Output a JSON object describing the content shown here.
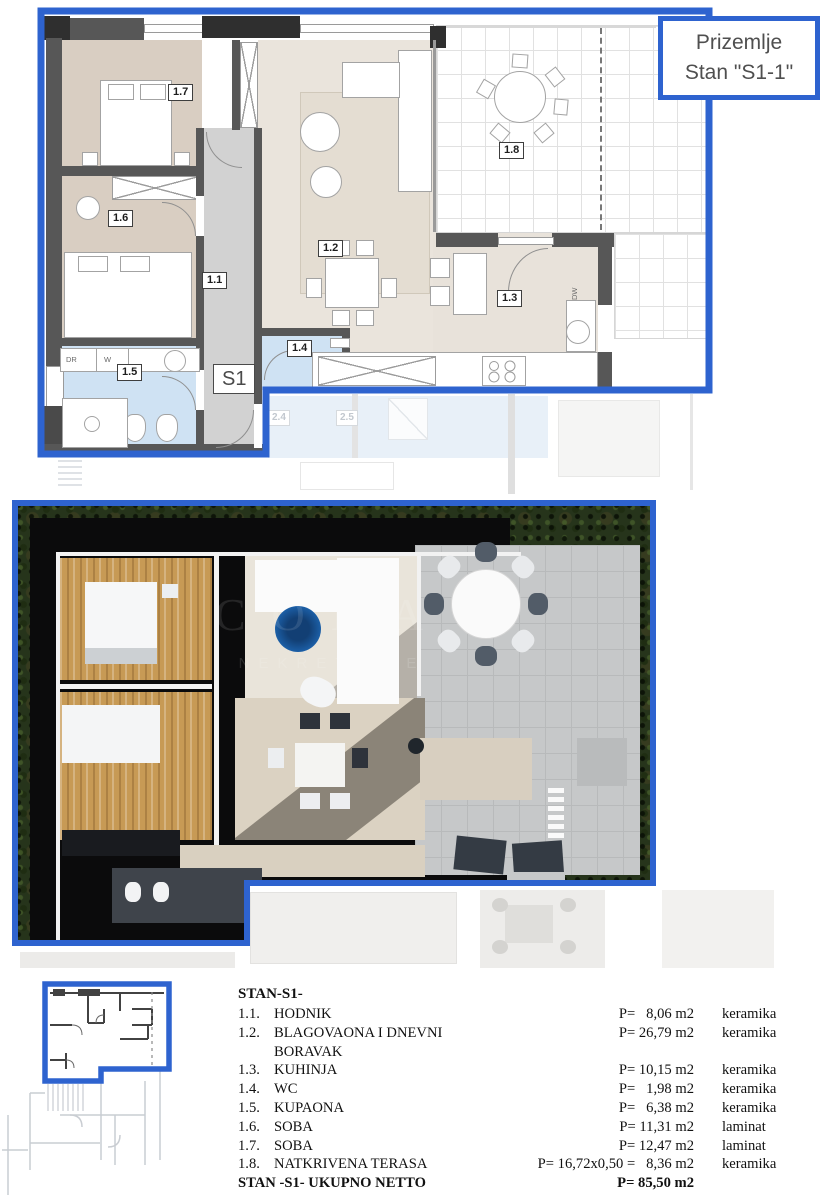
{
  "title_box": {
    "line1": "Prizemlje",
    "line2": "Stan \"S1-1\""
  },
  "plan2d": {
    "room_labels": [
      "1.7",
      "1.6",
      "1.1",
      "1.2",
      "1.3",
      "1.4",
      "1.5",
      "1.8",
      "S1"
    ],
    "appliance_labels": {
      "dr": "DR",
      "w": "W",
      "dw": "DW"
    },
    "ghost_labels": [
      "2.4",
      "2.5"
    ]
  },
  "render3d": {
    "watermark_top": "CODA",
    "watermark_bottom": "NEKRETNINE"
  },
  "legend": {
    "heading": "STAN-S1-",
    "rows": [
      {
        "no": "1.1.",
        "name": "HODNIK",
        "area": "P=   8,06 m2",
        "material": "keramika"
      },
      {
        "no": "1.2.",
        "name": "BLAGOVAONA I DNEVNI BORAVAK",
        "area": "P= 26,79 m2",
        "material": "keramika"
      },
      {
        "no": "1.3.",
        "name": "KUHINJA",
        "area": "P= 10,15 m2",
        "material": "keramika"
      },
      {
        "no": "1.4.",
        "name": "WC",
        "area": "P=   1,98 m2",
        "material": "keramika"
      },
      {
        "no": "1.5.",
        "name": "KUPAONA",
        "area": "P=   6,38 m2",
        "material": "keramika"
      },
      {
        "no": "1.6.",
        "name": "SOBA",
        "area": "P= 11,31 m2",
        "material": "laminat"
      },
      {
        "no": "1.7.",
        "name": "SOBA",
        "area": "P= 12,47 m2",
        "material": "laminat"
      },
      {
        "no": "1.8.",
        "name": "NATKRIVENA TERASA",
        "area": "P= 16,72x0,50 =   8,36 m2",
        "material": "keramika"
      }
    ],
    "total": {
      "label": "STAN -S1- UKUPNO NETTO",
      "area": "P= 85,50 m2"
    }
  },
  "colors": {
    "frame_blue": "#2e63cf",
    "wall_gray": "#575757",
    "bath_blue": "#cfe2f3",
    "bedroom_beige": "#d9cec2",
    "living_beige": "#eae4dc",
    "hedge_green": "#26341b",
    "rug_blue": "#1d63ad"
  }
}
